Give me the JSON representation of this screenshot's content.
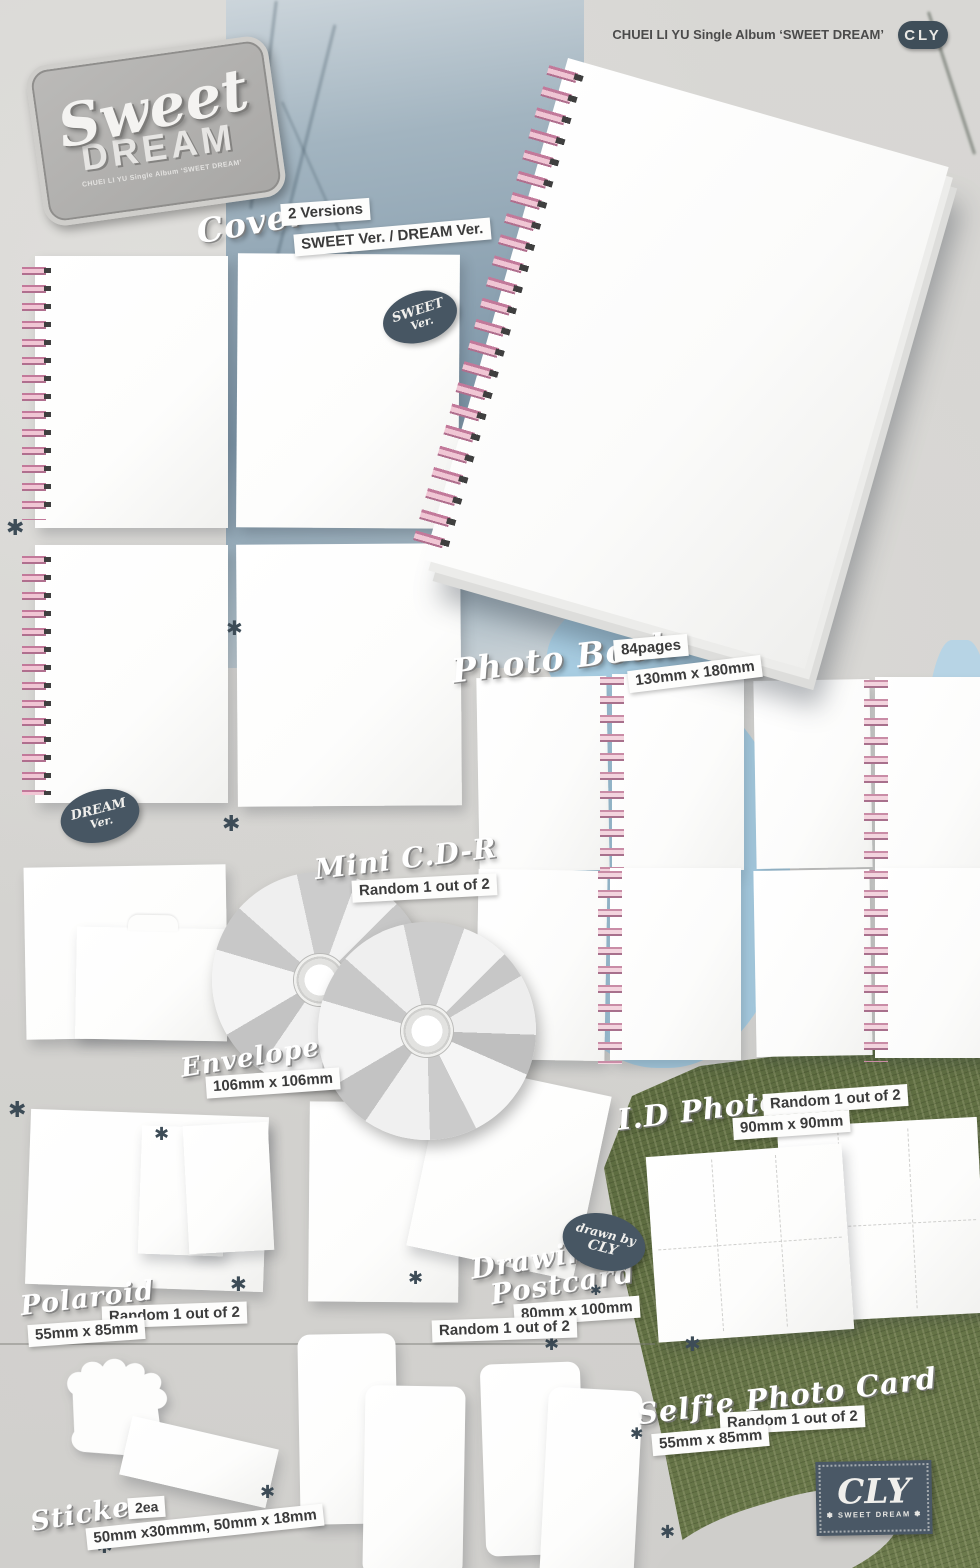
{
  "header": {
    "album": "CHUEI LI YU Single Album ‘SWEET DREAM’",
    "brand": "CLY"
  },
  "logo": {
    "word1": "Sweet",
    "word2": "DREAM",
    "sub": "CHUEI LI YU Single Album ‘SWEET DREAM’"
  },
  "badges": {
    "sweet": {
      "l1": "SWEET",
      "l2": "Ver."
    },
    "dream": {
      "l1": "DREAM",
      "l2": "Ver."
    },
    "drawn_by": {
      "l1": "drawn by",
      "l2": "CLY"
    }
  },
  "cover": {
    "title": "Cover",
    "versions": "2 Versions",
    "detail": "SWEET Ver. / DREAM Ver."
  },
  "photo_book": {
    "title": "Photo Book",
    "pages": "84pages",
    "size": "130mm x 180mm"
  },
  "mini_cdr": {
    "title": "Mini C.D-R",
    "random": "Random 1 out of 2"
  },
  "envelope": {
    "title": "Envelope",
    "size": "106mm x 106mm"
  },
  "id_photo": {
    "title": "I.D Photo",
    "random": "Random 1 out of 2",
    "size": "90mm x 90mm"
  },
  "polaroid": {
    "title": "Polaroid",
    "random": "Random 1 out of 2",
    "size": "55mm x 85mm"
  },
  "drawing_postcard": {
    "t1": "Drawing",
    "t2": "Postcard",
    "size": "80mm x 100mm",
    "random": "Random 1 out of 2"
  },
  "selfie_card": {
    "title": "Selfie Photo Card",
    "random": "Random 1 out of 2",
    "size": "55mm x 85mm"
  },
  "sticker": {
    "title": "Sticker",
    "qty": "2ea",
    "size": "50mm x30mmm, 50mm x 18mm"
  },
  "stamp": {
    "brand": "CLY",
    "sub": "✽ SWEET DREAM ✽"
  },
  "decor": {
    "star": "✱"
  },
  "colors": {
    "slate": "#475663",
    "coil_pink": "#f0c6d4",
    "grass": "#66744a",
    "label_text": "#3b3b3b"
  }
}
